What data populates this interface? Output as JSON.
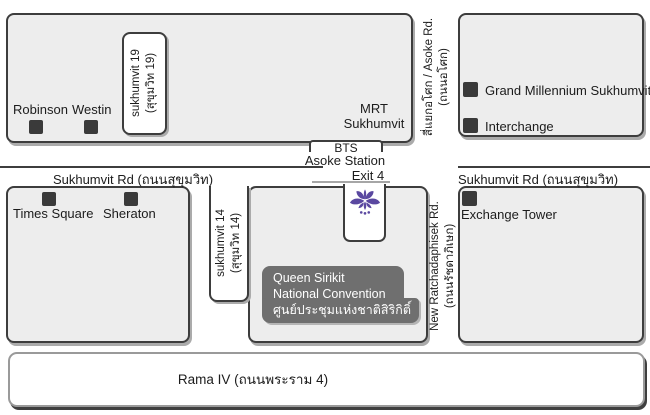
{
  "map": {
    "roads": {
      "sukhumvit_left": "Sukhumvit Rd (ถนนสุขุมวิท)",
      "sukhumvit_right": "Sukhumvit Rd (ถนนสุขุมวิท)",
      "rama4": "Rama IV (ถนนพระราม 4)",
      "soi19_line1": "sukhumvit 19",
      "soi19_line2": "(สุขุมวิท 19)",
      "soi14_line1": "sukhumvit 14",
      "soi14_line2": "(สุขุมวิท 14)",
      "asoke_line1": "สี่แยกอโศก / Asoke Rd.",
      "asoke_line2": "(ถนนอโศก)",
      "ratchadaphisek_line1": "New Ratchadaphisek Rd.",
      "ratchadaphisek_line2": "(ถนนรัชดาภิเษก)"
    },
    "transit": {
      "bts_line1": "BTS",
      "bts_line2": "Asoke Station",
      "exit": "Exit 4",
      "mrt_line1": "MRT",
      "mrt_line2": "Sukhumvit"
    },
    "landmarks": [
      {
        "name": "Robinson"
      },
      {
        "name": "Westin"
      },
      {
        "name": "Times Square"
      },
      {
        "name": "Sheraton"
      },
      {
        "name": "Grand Millennium Sukhumvit"
      },
      {
        "name": "Interchange"
      },
      {
        "name": "Exchange Tower"
      }
    ],
    "venue": {
      "line1": "Queen Sirikit",
      "line2": "National Convention",
      "line3": "ศูนย์ประชุมแห่งชาติสิริกิติ์"
    },
    "colors": {
      "flower_purple": "#5a48a0",
      "venue_box_gray": "#6f6f6f",
      "block_fill": "#ededed",
      "outline": "#3d3d3d",
      "marker": "#3a3a3a"
    }
  }
}
